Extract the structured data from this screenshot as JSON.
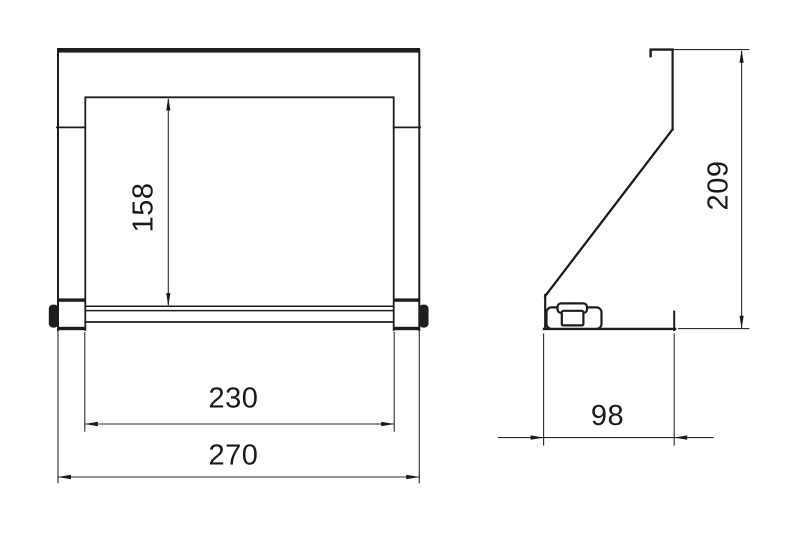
{
  "page": {
    "background": "#ffffff"
  },
  "drawing": {
    "line_color": "#1d1d1d",
    "text_color": "#1a1a1a",
    "dimensions": {
      "front_opening_height": "158",
      "front_inner_width": "230",
      "front_overall_width": "270",
      "side_overall_height": "209",
      "side_base_depth": "98"
    }
  }
}
